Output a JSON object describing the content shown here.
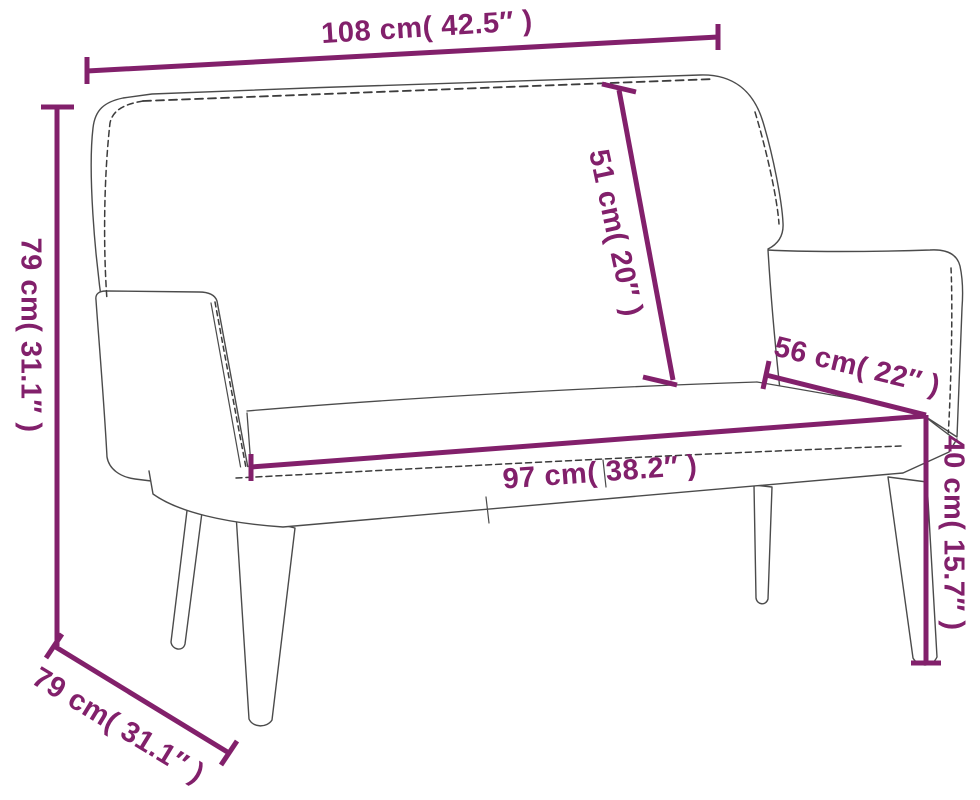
{
  "diagram": {
    "subject": "bench-dimension-drawing",
    "dimensions": {
      "overall_width": {
        "label": "108 cm( 42.5″ )",
        "cm": 108,
        "inches": 42.5
      },
      "overall_height": {
        "label": "79 cm( 31.1″ )",
        "cm": 79,
        "inches": 31.1
      },
      "backrest_height": {
        "label": "51 cm( 20″ )",
        "cm": 51,
        "inches": 20
      },
      "top_depth": {
        "label": "56 cm( 22″ )",
        "cm": 56,
        "inches": 22
      },
      "seat_width": {
        "label": "97 cm( 38.2″ )",
        "cm": 97,
        "inches": 38.2
      },
      "seat_height": {
        "label": "40 cm( 15.7″ )",
        "cm": 40,
        "inches": 15.7
      },
      "base_depth": {
        "label": "79 cm( 31.1″ )",
        "cm": 79,
        "inches": 31.1
      }
    },
    "colors": {
      "dimension_accent": "#82206B",
      "outline": "#4B4B4B",
      "stitch": "#3C3C3C",
      "background": "#FFFFFF"
    }
  }
}
